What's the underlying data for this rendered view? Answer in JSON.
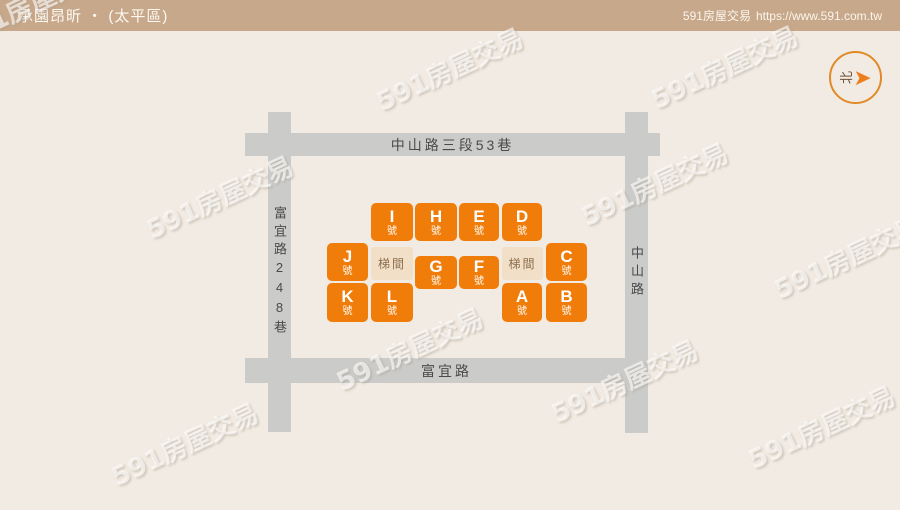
{
  "header": {
    "title": "承園昂昕 ‧ (太平區)",
    "brand": "591房屋交易",
    "url": "https://www.591.com.tw"
  },
  "watermark": {
    "text": "591房屋交易"
  },
  "compass": {
    "north_label": "北",
    "arrow_glyph": "➤"
  },
  "map": {
    "roads": {
      "top": {
        "label": "中山路三段53巷"
      },
      "bottom": {
        "label": "富宜路"
      },
      "left": {
        "label": "富宜路248巷"
      },
      "right": {
        "label": "中山路"
      }
    },
    "units": [
      {
        "letter": "I",
        "suffix": "號"
      },
      {
        "letter": "H",
        "suffix": "號"
      },
      {
        "letter": "E",
        "suffix": "號"
      },
      {
        "letter": "D",
        "suffix": "號"
      },
      {
        "letter": "J",
        "suffix": "號"
      },
      {
        "letter": "G",
        "suffix": "號"
      },
      {
        "letter": "F",
        "suffix": "號"
      },
      {
        "letter": "C",
        "suffix": "號"
      },
      {
        "letter": "K",
        "suffix": "號"
      },
      {
        "letter": "L",
        "suffix": "號"
      },
      {
        "letter": "A",
        "suffix": "號"
      },
      {
        "letter": "B",
        "suffix": "號"
      }
    ],
    "stairwells": [
      {
        "label": "梯間"
      },
      {
        "label": "梯間"
      }
    ]
  },
  "colors": {
    "accent_orange": "#F07D0A",
    "header_tan": "#C8A88A",
    "road_gray": "#CBCCCA",
    "stair_beige": "#F2DFC7",
    "background_beige": "#F1EBE3",
    "compass_ring_orange": "#E08A28"
  }
}
